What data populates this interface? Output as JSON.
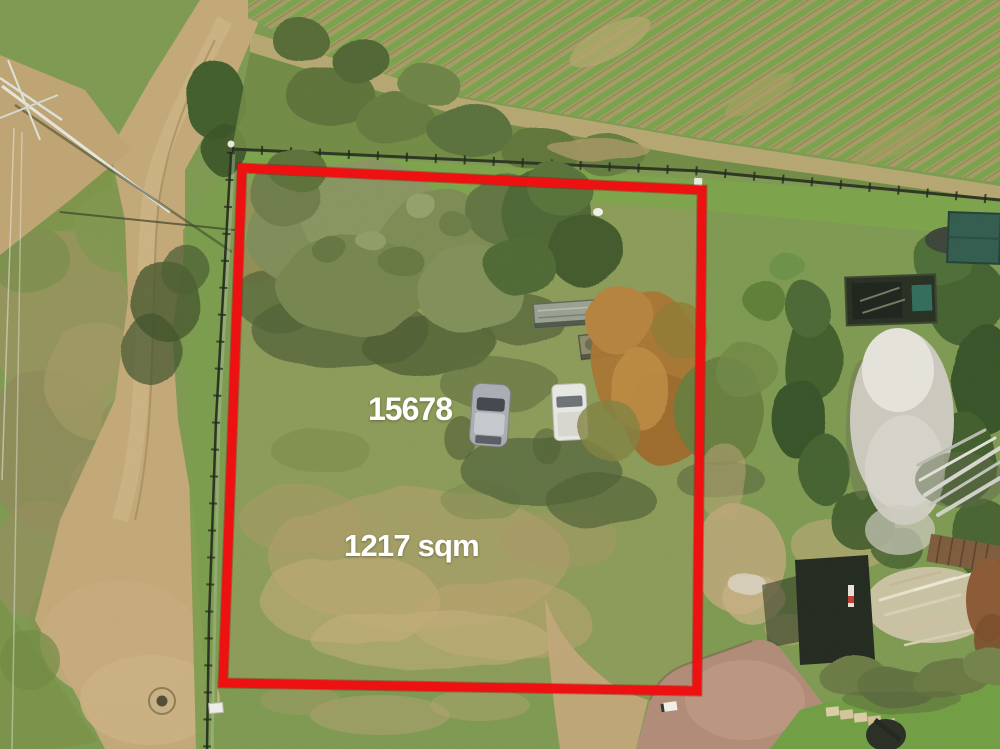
{
  "annotations": {
    "lot_number": "15678",
    "area_label": "1217 sqm"
  },
  "boundary": {
    "color": "#ee1111"
  },
  "label_style": {
    "color": "#ffffff"
  }
}
